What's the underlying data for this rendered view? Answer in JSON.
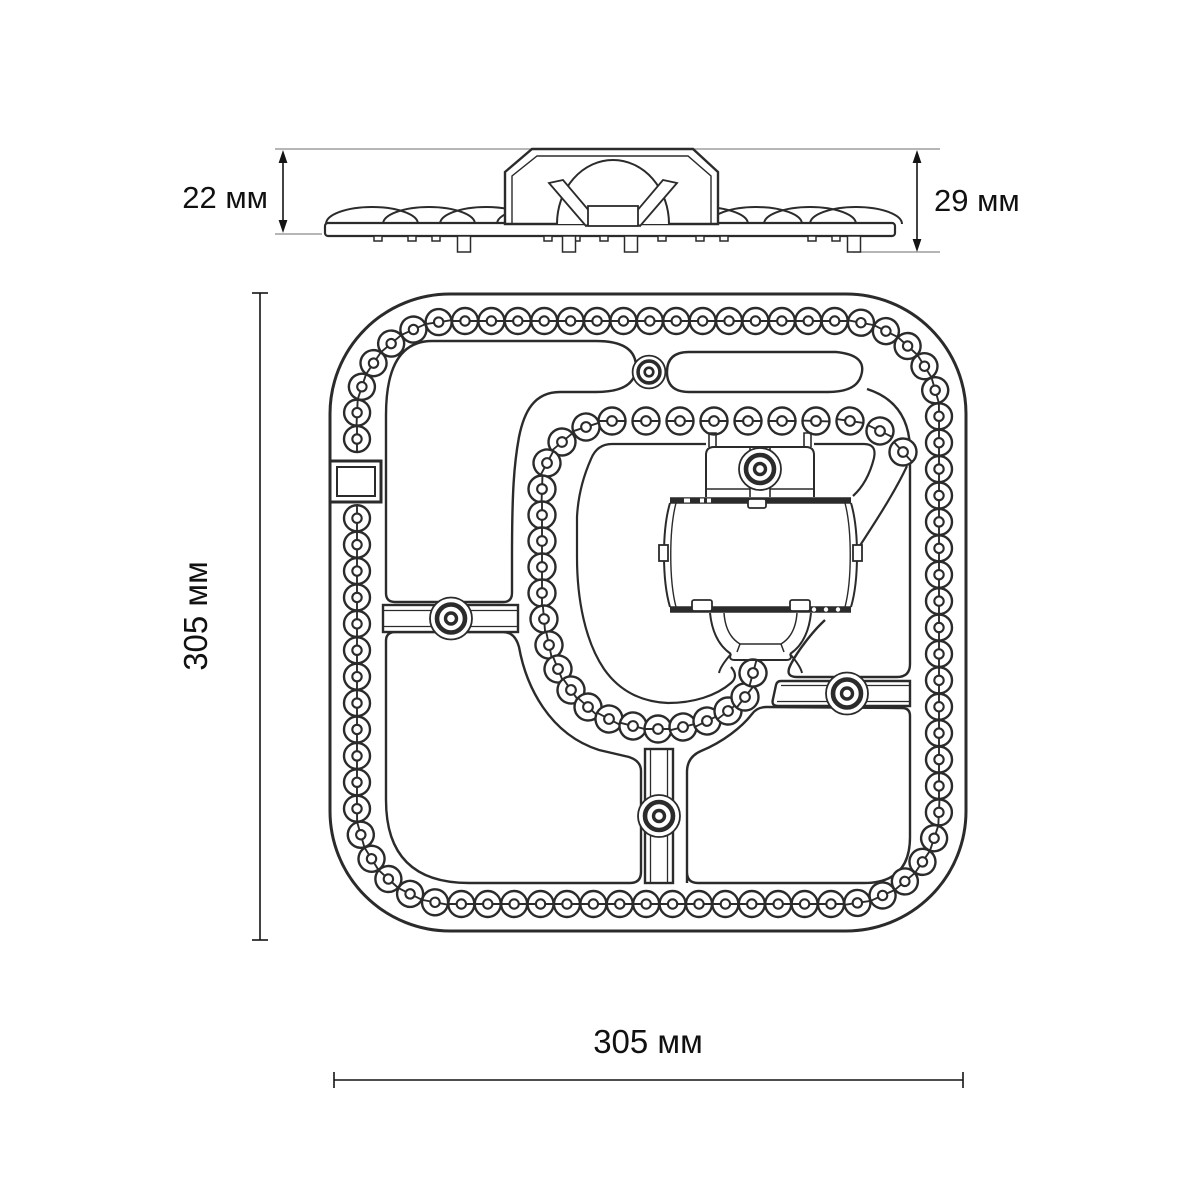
{
  "drawing": {
    "type": "technical-drawing-led-module",
    "side_view": {
      "height_body_label": "22 мм",
      "height_total_label": "29 мм"
    },
    "top_view": {
      "height_label": "305 мм",
      "width_label": "305 мм"
    },
    "colors": {
      "line": "#2b2b2b",
      "dimension_line": "#141414",
      "extension_line": "#8a8a8a",
      "background": "#ffffff"
    }
  }
}
